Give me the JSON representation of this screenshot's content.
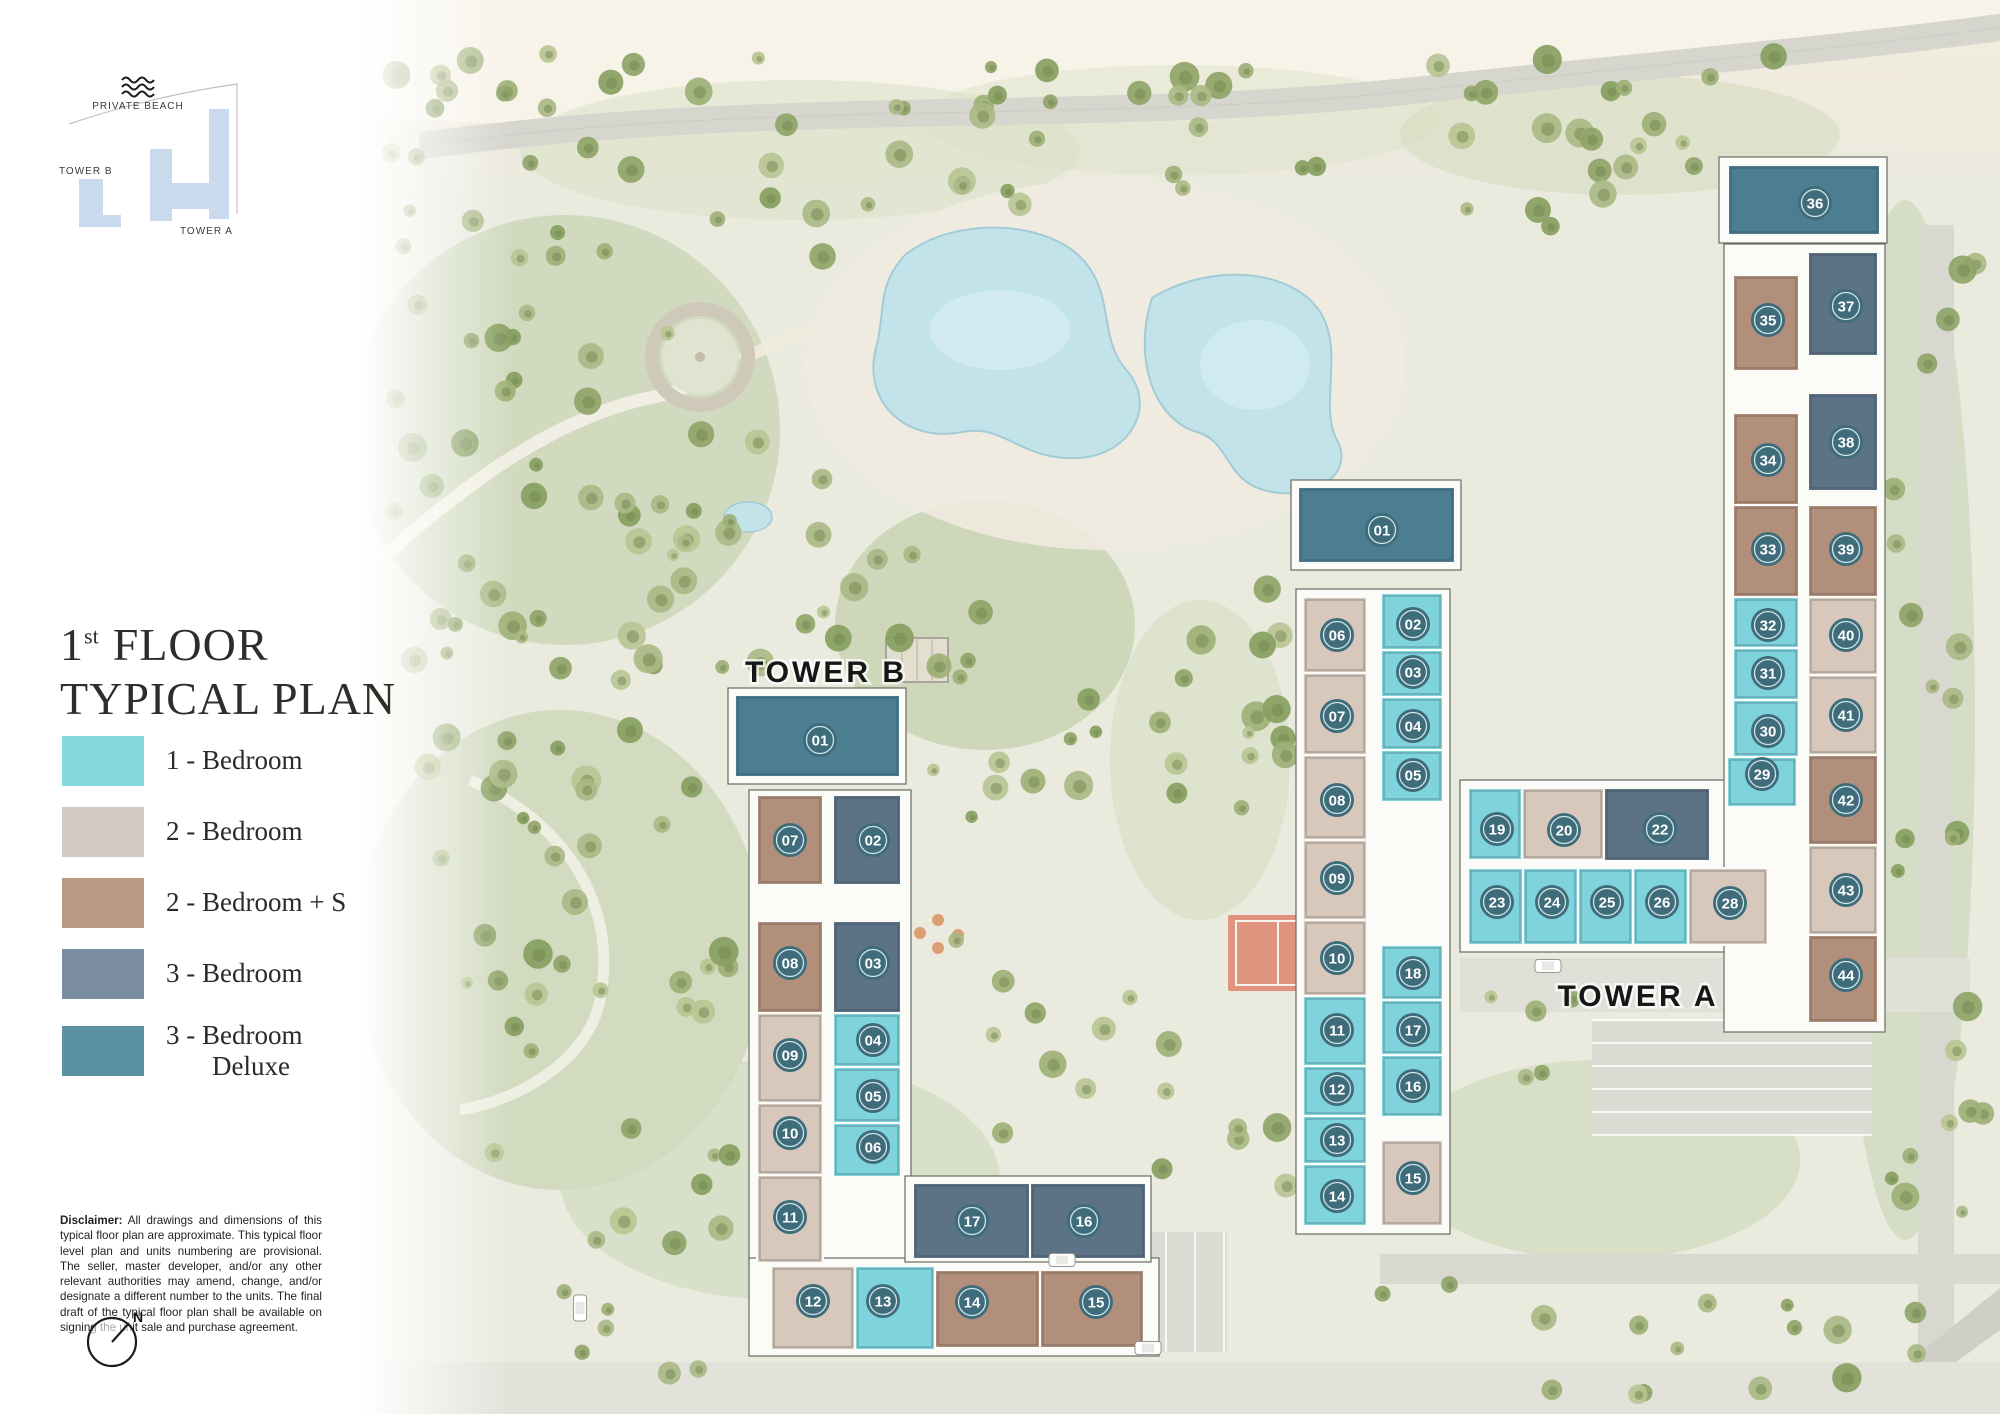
{
  "key_plan": {
    "private_beach_label": "PRIVATE BEACH",
    "tower_b_label": "TOWER B",
    "tower_a_label": "TOWER A",
    "shape_color": "#c9dbed"
  },
  "title": {
    "line1_number": "1",
    "line1_sup": "st",
    "line1_text": "FLOOR",
    "line2": "TYPICAL PLAN"
  },
  "legend": {
    "items": [
      {
        "key": "1br",
        "label": "1 - Bedroom",
        "label2": "",
        "color": "#86d9df"
      },
      {
        "key": "2br",
        "label": "2 - Bedroom",
        "label2": "",
        "color": "#d3cac1"
      },
      {
        "key": "2brs",
        "label": "2 - Bedroom + S",
        "label2": "",
        "color": "#bb9884"
      },
      {
        "key": "3br",
        "label": "3 - Bedroom",
        "label2": "",
        "color": "#7b8da0"
      },
      {
        "key": "3brd",
        "label": "3 - Bedroom",
        "label2": "Deluxe",
        "color": "#5b91a3"
      }
    ]
  },
  "disclaimer": {
    "heading": "Disclaimer:",
    "body": "All drawings and dimensions of this typical floor plan are approximate. This typical floor level plan and units numbering are provisional. The seller, master developer, and/or any other relevant authorities may amend, change, and/or designate a different number to the units. The final draft of the typical floor plan shall be available on signing the unit sale and purchase agreement."
  },
  "compass": {
    "north_label": "N"
  },
  "plan": {
    "unit_colors": {
      "1br": "#7ed3dc",
      "2br": "#d8c8bc",
      "2brs": "#b28f7a",
      "3br": "#5c7287",
      "3brd": "#4b7e91"
    },
    "badge": {
      "fill": "#3f6c7a",
      "ring": "#cfe4e7",
      "text_color": "#ffffff"
    },
    "tower_b": {
      "label": "TOWER B",
      "label_x": 826,
      "label_y": 682,
      "units": [
        {
          "no": "01",
          "type": "3brd",
          "x": 735,
          "y": 695,
          "w": 165,
          "h": 82,
          "bx": 820,
          "by": 740
        },
        {
          "no": "07",
          "type": "2brs",
          "x": 757,
          "y": 795,
          "w": 66,
          "h": 90,
          "bx": 790,
          "by": 840
        },
        {
          "no": "02",
          "type": "3br",
          "x": 833,
          "y": 795,
          "w": 68,
          "h": 90,
          "bx": 873,
          "by": 840
        },
        {
          "no": "08",
          "type": "2brs",
          "x": 757,
          "y": 921,
          "w": 66,
          "h": 92,
          "bx": 790,
          "by": 963
        },
        {
          "no": "03",
          "type": "3br",
          "x": 833,
          "y": 921,
          "w": 68,
          "h": 92,
          "bx": 873,
          "by": 963
        },
        {
          "no": "09",
          "type": "2br",
          "x": 757,
          "y": 1013,
          "w": 66,
          "h": 90,
          "bx": 790,
          "by": 1055
        },
        {
          "no": "04",
          "type": "1br",
          "x": 833,
          "y": 1013,
          "w": 68,
          "h": 54,
          "bx": 873,
          "by": 1040
        },
        {
          "no": "05",
          "type": "1br",
          "x": 833,
          "y": 1067,
          "w": 68,
          "h": 56,
          "bx": 873,
          "by": 1096
        },
        {
          "no": "10",
          "type": "2br",
          "x": 757,
          "y": 1103,
          "w": 66,
          "h": 72,
          "bx": 790,
          "by": 1133
        },
        {
          "no": "06",
          "type": "1br",
          "x": 833,
          "y": 1123,
          "w": 68,
          "h": 54,
          "bx": 873,
          "by": 1147
        },
        {
          "no": "11",
          "type": "2br",
          "x": 757,
          "y": 1175,
          "w": 66,
          "h": 88,
          "bx": 790,
          "by": 1217
        },
        {
          "no": "12",
          "type": "2br",
          "x": 771,
          "y": 1266,
          "w": 84,
          "h": 84,
          "bx": 813,
          "by": 1301
        },
        {
          "no": "13",
          "type": "1br",
          "x": 855,
          "y": 1266,
          "w": 80,
          "h": 84,
          "bx": 883,
          "by": 1301
        },
        {
          "no": "17",
          "type": "3br",
          "x": 913,
          "y": 1183,
          "w": 117,
          "h": 76,
          "bx": 972,
          "by": 1221
        },
        {
          "no": "16",
          "type": "3br",
          "x": 1030,
          "y": 1183,
          "w": 116,
          "h": 76,
          "bx": 1084,
          "by": 1221
        },
        {
          "no": "14",
          "type": "2brs",
          "x": 935,
          "y": 1270,
          "w": 105,
          "h": 78,
          "bx": 972,
          "by": 1302
        },
        {
          "no": "15",
          "type": "2brs",
          "x": 1040,
          "y": 1270,
          "w": 104,
          "h": 78,
          "bx": 1096,
          "by": 1302
        }
      ]
    },
    "tower_a": {
      "label": "TOWER A",
      "label_x": 1638,
      "label_y": 1006,
      "units": [
        {
          "no": "01",
          "type": "3brd",
          "x": 1298,
          "y": 487,
          "w": 157,
          "h": 76,
          "bx": 1382,
          "by": 530
        },
        {
          "no": "06",
          "type": "2br",
          "x": 1303,
          "y": 597,
          "w": 64,
          "h": 76,
          "bx": 1337,
          "by": 635
        },
        {
          "no": "07",
          "type": "2br",
          "x": 1303,
          "y": 673,
          "w": 64,
          "h": 82,
          "bx": 1337,
          "by": 716
        },
        {
          "no": "08",
          "type": "2br",
          "x": 1303,
          "y": 755,
          "w": 64,
          "h": 85,
          "bx": 1337,
          "by": 800
        },
        {
          "no": "09",
          "type": "2br",
          "x": 1303,
          "y": 840,
          "w": 64,
          "h": 80,
          "bx": 1337,
          "by": 878
        },
        {
          "no": "10",
          "type": "2br",
          "x": 1303,
          "y": 920,
          "w": 64,
          "h": 76,
          "bx": 1337,
          "by": 958
        },
        {
          "no": "11",
          "type": "1br",
          "x": 1303,
          "y": 996,
          "w": 64,
          "h": 70,
          "bx": 1337,
          "by": 1030
        },
        {
          "no": "12",
          "type": "1br",
          "x": 1303,
          "y": 1066,
          "w": 64,
          "h": 50,
          "bx": 1337,
          "by": 1089
        },
        {
          "no": "13",
          "type": "1br",
          "x": 1303,
          "y": 1116,
          "w": 64,
          "h": 48,
          "bx": 1337,
          "by": 1140
        },
        {
          "no": "14",
          "type": "1br",
          "x": 1303,
          "y": 1164,
          "w": 64,
          "h": 62,
          "bx": 1337,
          "by": 1196
        },
        {
          "no": "02",
          "type": "1br",
          "x": 1381,
          "y": 593,
          "w": 62,
          "h": 57,
          "bx": 1413,
          "by": 624
        },
        {
          "no": "03",
          "type": "1br",
          "x": 1381,
          "y": 650,
          "w": 62,
          "h": 47,
          "bx": 1413,
          "by": 672
        },
        {
          "no": "04",
          "type": "1br",
          "x": 1381,
          "y": 697,
          "w": 62,
          "h": 53,
          "bx": 1413,
          "by": 726
        },
        {
          "no": "05",
          "type": "1br",
          "x": 1381,
          "y": 750,
          "w": 62,
          "h": 52,
          "bx": 1413,
          "by": 775
        },
        {
          "no": "18",
          "type": "1br",
          "x": 1381,
          "y": 945,
          "w": 62,
          "h": 55,
          "bx": 1413,
          "by": 973
        },
        {
          "no": "17",
          "type": "1br",
          "x": 1381,
          "y": 1000,
          "w": 62,
          "h": 55,
          "bx": 1413,
          "by": 1030
        },
        {
          "no": "16",
          "type": "1br",
          "x": 1381,
          "y": 1055,
          "w": 62,
          "h": 62,
          "bx": 1413,
          "by": 1086
        },
        {
          "no": "15",
          "type": "2br",
          "x": 1381,
          "y": 1140,
          "w": 62,
          "h": 86,
          "bx": 1413,
          "by": 1178
        },
        {
          "no": "19",
          "type": "1br",
          "x": 1468,
          "y": 788,
          "w": 54,
          "h": 72,
          "bx": 1497,
          "by": 829
        },
        {
          "no": "20",
          "type": "2br",
          "x": 1522,
          "y": 788,
          "w": 82,
          "h": 72,
          "bx": 1564,
          "by": 830
        },
        {
          "no": "22",
          "type": "3br",
          "x": 1604,
          "y": 788,
          "w": 106,
          "h": 73,
          "bx": 1660,
          "by": 829
        },
        {
          "no": "23",
          "type": "1br",
          "x": 1468,
          "y": 868,
          "w": 55,
          "h": 77,
          "bx": 1497,
          "by": 902
        },
        {
          "no": "24",
          "type": "1br",
          "x": 1523,
          "y": 868,
          "w": 55,
          "h": 77,
          "bx": 1552,
          "by": 902
        },
        {
          "no": "25",
          "type": "1br",
          "x": 1578,
          "y": 868,
          "w": 55,
          "h": 77,
          "bx": 1607,
          "by": 902
        },
        {
          "no": "26",
          "type": "1br",
          "x": 1633,
          "y": 868,
          "w": 55,
          "h": 77,
          "bx": 1662,
          "by": 902
        },
        {
          "no": "28",
          "type": "2br",
          "x": 1688,
          "y": 868,
          "w": 80,
          "h": 77,
          "bx": 1730,
          "by": 903
        },
        {
          "no": "36",
          "type": "3brd",
          "x": 1728,
          "y": 165,
          "w": 152,
          "h": 70,
          "bx": 1815,
          "by": 203
        },
        {
          "no": "35",
          "type": "2brs",
          "x": 1733,
          "y": 275,
          "w": 66,
          "h": 96,
          "bx": 1768,
          "by": 320
        },
        {
          "no": "34",
          "type": "2brs",
          "x": 1733,
          "y": 413,
          "w": 66,
          "h": 92,
          "bx": 1768,
          "by": 460
        },
        {
          "no": "33",
          "type": "2brs",
          "x": 1733,
          "y": 505,
          "w": 66,
          "h": 92,
          "bx": 1768,
          "by": 549
        },
        {
          "no": "32",
          "type": "1br",
          "x": 1733,
          "y": 597,
          "w": 66,
          "h": 51,
          "bx": 1768,
          "by": 625
        },
        {
          "no": "31",
          "type": "1br",
          "x": 1733,
          "y": 648,
          "w": 66,
          "h": 52,
          "bx": 1768,
          "by": 673
        },
        {
          "no": "30",
          "type": "1br",
          "x": 1733,
          "y": 700,
          "w": 66,
          "h": 57,
          "bx": 1768,
          "by": 731
        },
        {
          "no": "29",
          "type": "1br",
          "x": 1727,
          "y": 757,
          "w": 70,
          "h": 50,
          "bx": 1762,
          "by": 774
        },
        {
          "no": "37",
          "type": "3br",
          "x": 1808,
          "y": 252,
          "w": 70,
          "h": 104,
          "bx": 1846,
          "by": 306
        },
        {
          "no": "38",
          "type": "3br",
          "x": 1808,
          "y": 393,
          "w": 70,
          "h": 98,
          "bx": 1846,
          "by": 442
        },
        {
          "no": "39",
          "type": "2brs",
          "x": 1808,
          "y": 505,
          "w": 70,
          "h": 92,
          "bx": 1846,
          "by": 549
        },
        {
          "no": "40",
          "type": "2br",
          "x": 1808,
          "y": 597,
          "w": 70,
          "h": 78,
          "bx": 1846,
          "by": 635
        },
        {
          "no": "41",
          "type": "2br",
          "x": 1808,
          "y": 675,
          "w": 70,
          "h": 80,
          "bx": 1846,
          "by": 715
        },
        {
          "no": "42",
          "type": "2brs",
          "x": 1808,
          "y": 755,
          "w": 70,
          "h": 90,
          "bx": 1846,
          "by": 800
        },
        {
          "no": "43",
          "type": "2br",
          "x": 1808,
          "y": 845,
          "w": 70,
          "h": 90,
          "bx": 1846,
          "by": 890
        },
        {
          "no": "44",
          "type": "2brs",
          "x": 1808,
          "y": 935,
          "w": 70,
          "h": 88,
          "bx": 1846,
          "by": 975
        }
      ]
    }
  }
}
